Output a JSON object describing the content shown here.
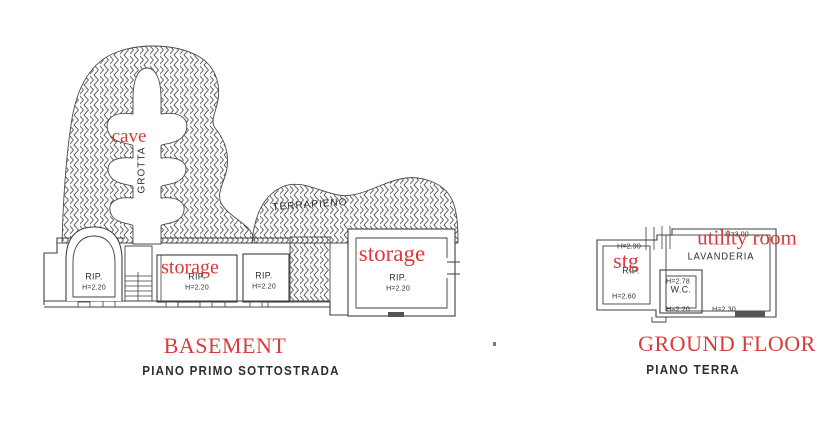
{
  "palette": {
    "annotation_red": "#d93a3a",
    "line_dark": "#3f3f3f",
    "hatch_gray": "#5a5a5a"
  },
  "basement": {
    "annotations": {
      "cave": "cave",
      "storage_small": "storage",
      "storage_large": "storage"
    },
    "plan_labels": {
      "grotta": "GROTTA",
      "terrapieno": "TERRAPIENO"
    },
    "rooms": [
      {
        "name": "RIP.",
        "height": "H=2.20"
      },
      {
        "name": "RIP.",
        "height": "H=2.20"
      },
      {
        "name": "RIP.",
        "height": "H=2.20"
      },
      {
        "name": "RIP.",
        "height": "H=2.20"
      }
    ],
    "title_en": "BASEMENT",
    "title_it": "PIANO PRIMO SOTTOSTRADA"
  },
  "ground_floor": {
    "annotations": {
      "stg": "stg",
      "utility_room": "utility room"
    },
    "rooms": {
      "storage": {
        "name": "RIP.",
        "h_top": "H=2.90",
        "h_bottom": "H=2.60"
      },
      "laundry": {
        "name": "LAVANDERIA",
        "h_top": "H=3.00",
        "h_bottom_right": "H=2.30"
      },
      "wc": {
        "name": "W.C.",
        "h_top": "H=2.78",
        "h_bottom": "H=2.20"
      }
    },
    "title_en": "GROUND FLOOR",
    "title_it": "PIANO TERRA"
  }
}
